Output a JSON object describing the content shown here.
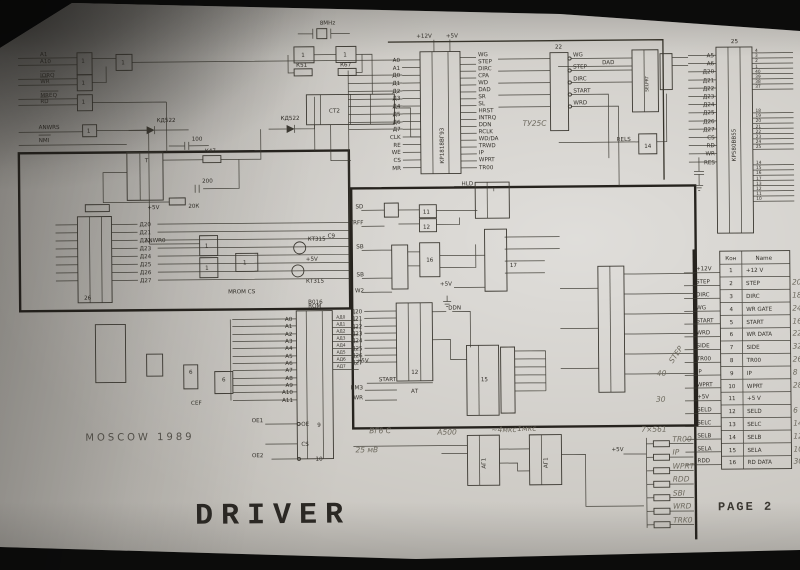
{
  "titles": {
    "driver": "DRIVER",
    "page": "PAGE 2",
    "moscow": "MOSCOW 1989"
  },
  "osc": {
    "freq": "8MHz",
    "inv1": "1",
    "inv2": "1",
    "r1": "К51",
    "r2": "К67",
    "ct": "CT2"
  },
  "gates": {
    "g1": "1",
    "g2": "1",
    "g3": "1",
    "g4": "1",
    "g5": "1",
    "g11": "11",
    "g12": "12",
    "g16": "16",
    "g6a": "6",
    "g6b": "6",
    "cef": "CEF"
  },
  "cpu": {
    "a1": "A1",
    "a10": "A10",
    "iorq": "IORQ",
    "wr": "WR",
    "mreq": "MREQ",
    "rd": "RD",
    "anwrs": "ANWRS",
    "nmi": "NMI"
  },
  "fdc": {
    "part": "КР1818ВГ93",
    "p12": "+12V",
    "p5": "+5V",
    "left": [
      "A0",
      "A1",
      "Д0",
      "Д1",
      "Д2",
      "Д3",
      "Д4",
      "Д5",
      "Д6",
      "Д7",
      "CLK",
      "RE",
      "WE",
      "CS",
      "MR"
    ],
    "right": [
      "WG",
      "STEP",
      "DIRC",
      "CPA",
      "WD",
      "DAD",
      "SR",
      "SL",
      "HRST",
      "INTRQ",
      "DDN",
      "RCLK",
      "WD/DA",
      "TRWD",
      "IP",
      "WPRT",
      "TR00"
    ]
  },
  "buf": {
    "des": "22",
    "out": [
      "WG",
      "STEP",
      "DIRC",
      "START",
      "WRD"
    ],
    "note": "ТУ25С"
  },
  "sel": {
    "part": "SELPRT",
    "dad": "DAD",
    "rels": "RELS",
    "g14des": "14"
  },
  "ppi": {
    "des": "25",
    "part": "КР580ВВ55",
    "left": [
      "A5",
      "A6",
      "Д20",
      "Д21",
      "Д22",
      "Д23",
      "Д24",
      "Д25",
      "Д26",
      "Д27",
      "CS",
      "RD",
      "WR",
      "RES"
    ],
    "pa": [
      "4",
      "3",
      "2",
      "1",
      "40",
      "39",
      "38",
      "37"
    ],
    "pb": [
      "18",
      "19",
      "20",
      "21",
      "22",
      "23",
      "24",
      "25"
    ],
    "pc": [
      "14",
      "15",
      "16",
      "17",
      "13",
      "12",
      "11",
      "10"
    ]
  },
  "conn": {
    "hpin": "Кон",
    "hname": "Name",
    "rows": [
      {
        "s": "+12V",
        "p": "1",
        "n": "+12 V",
        "r": ""
      },
      {
        "s": "STEP",
        "p": "2",
        "n": "STEP",
        "r": "20"
      },
      {
        "s": "DIRC",
        "p": "3",
        "n": "DIRC",
        "r": "18"
      },
      {
        "s": "WG",
        "p": "4",
        "n": "WR GATE",
        "r": "24"
      },
      {
        "s": "START",
        "p": "5",
        "n": "START",
        "r": "16"
      },
      {
        "s": "WRD",
        "p": "6",
        "n": "WR DATA",
        "r": "22"
      },
      {
        "s": "SIDE",
        "p": "7",
        "n": "SIDE",
        "r": "32"
      },
      {
        "s": "TR00",
        "p": "8",
        "n": "TR00",
        "r": "26"
      },
      {
        "s": "IP",
        "p": "9",
        "n": "IP",
        "r": "8"
      },
      {
        "s": "WPRT",
        "p": "10",
        "n": "WPRT",
        "r": "28"
      },
      {
        "s": "+5V",
        "p": "11",
        "n": "+5 V",
        "r": ""
      },
      {
        "s": "SELD",
        "p": "12",
        "n": "SELD",
        "r": "6"
      },
      {
        "s": "SELC",
        "p": "13",
        "n": "SELC",
        "r": "14"
      },
      {
        "s": "SELB",
        "p": "14",
        "n": "SELB",
        "r": "12"
      },
      {
        "s": "SELA",
        "p": "15",
        "n": "SELA",
        "r": "10"
      },
      {
        "s": "RDD",
        "p": "16",
        "n": "RD DATA",
        "r": "30"
      }
    ]
  },
  "rnet": {
    "label": "7×561",
    "p5": "+5V",
    "sig": [
      "TR00",
      "IP",
      "WPRT",
      "RDD",
      "SBI",
      "WRD",
      "TRK0"
    ]
  },
  "mono": {
    "a": "АГ1",
    "b": "АГ1",
    "n1": "~4мкс",
    "n2": "1мкс",
    "n3": "А500",
    "n4": "ВГ6 С",
    "n5": "25 мВ"
  },
  "rom": {
    "title": "ROM",
    "addr": [
      "A0",
      "A1",
      "A2",
      "A3",
      "A4",
      "A5",
      "A6",
      "A7",
      "A8",
      "A9",
      "A10",
      "A11"
    ],
    "out": [
      "АД0",
      "АД1",
      "АД2",
      "АД3",
      "АД4",
      "АД5",
      "АД6",
      "АД7"
    ],
    "oe1": "ОЕ1",
    "oe2": "ОЕ2",
    "cs": "CS",
    "oe": "OE",
    "d9": "9",
    "d10": "10"
  },
  "left": {
    "des26": "26",
    "bus": [
      "Д20",
      "Д21",
      "Д22",
      "Д23",
      "Д24",
      "Д25",
      "Д26",
      "Д27"
    ]
  },
  "center": {
    "sd": "SD",
    "trff": "TRFF",
    "sb1": "SB",
    "sb2": "SB",
    "w2": "W2",
    "t": "T",
    "hld": "HLD",
    "d17": "17",
    "d12": "12",
    "d15": "15",
    "p5a": "+5V",
    "p5b": "+5V",
    "start": "START",
    "bm3": "ВМЗ",
    "wr": "WR",
    "at": "АТ",
    "ddn": "DDN",
    "step": "STEP",
    "n40": "40",
    "n30": "30"
  },
  "parts": {
    "t1": "T",
    "kd1": "КД522",
    "kd2": "КД522",
    "c100": "100",
    "r47": "К47",
    "r20k": "20К",
    "c200": "200",
    "kt1": "КТ315",
    "kt2": "КТ315",
    "c9": "C9",
    "mromcs": "MROM CS",
    "b016": "В016",
    "anwr0": "ANWR0"
  }
}
